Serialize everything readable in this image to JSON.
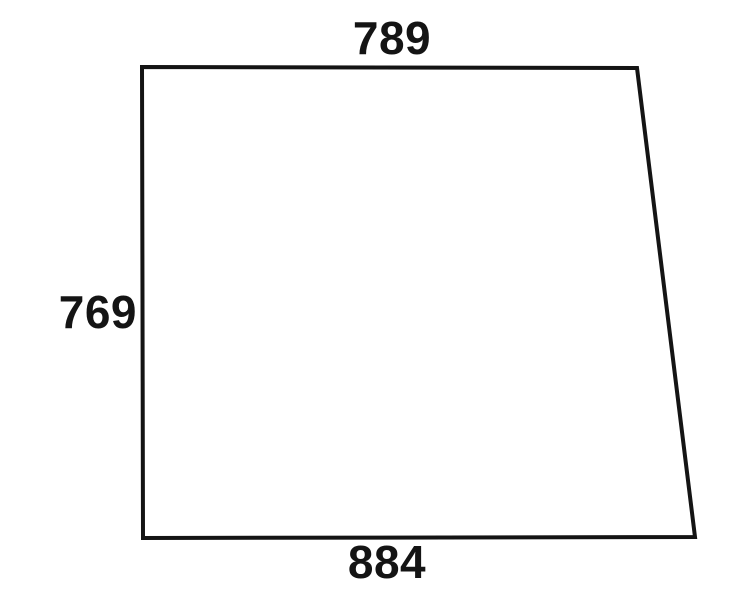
{
  "page": {
    "background": "#ffffff"
  },
  "diagram": {
    "type": "dimension-drawing",
    "shape": "trapezoid-panel",
    "line_color": "#141414",
    "text_color": "#141414",
    "dimensions": {
      "top": "789",
      "left": "769",
      "bottom": "884"
    }
  }
}
